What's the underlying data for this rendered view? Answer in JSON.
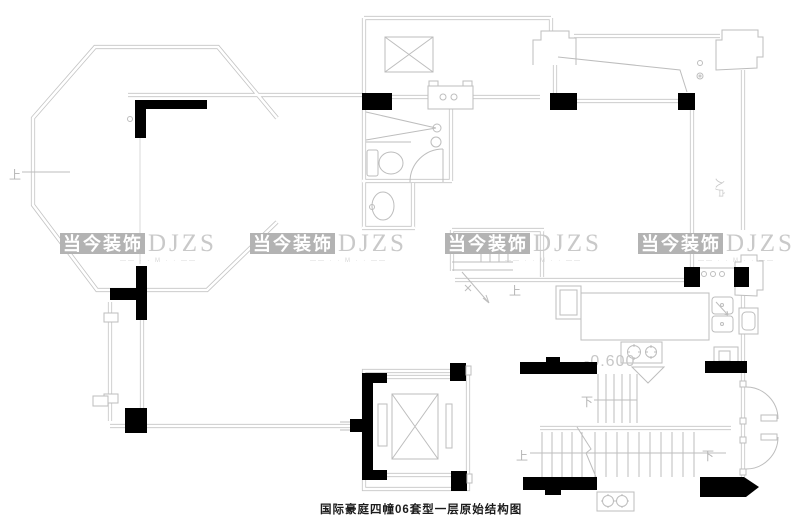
{
  "caption": "国际豪庭四幢06套型一层原始结构图",
  "watermark": {
    "brand": "当今装饰",
    "latin": "DJZS",
    "tagline": "—— · · M · · ——"
  },
  "labels": {
    "up": "上",
    "down": "下",
    "level": "-0.600",
    "entry": "入户"
  },
  "colors": {
    "line": "#c4c4c4",
    "black": "#000000",
    "watermark_block": "#b3b3b3",
    "watermark_text": "#ffffff",
    "watermark_latin": "#c9c9c9",
    "label_gray": "#b3b3b3",
    "caption": "#1c1c1c"
  }
}
